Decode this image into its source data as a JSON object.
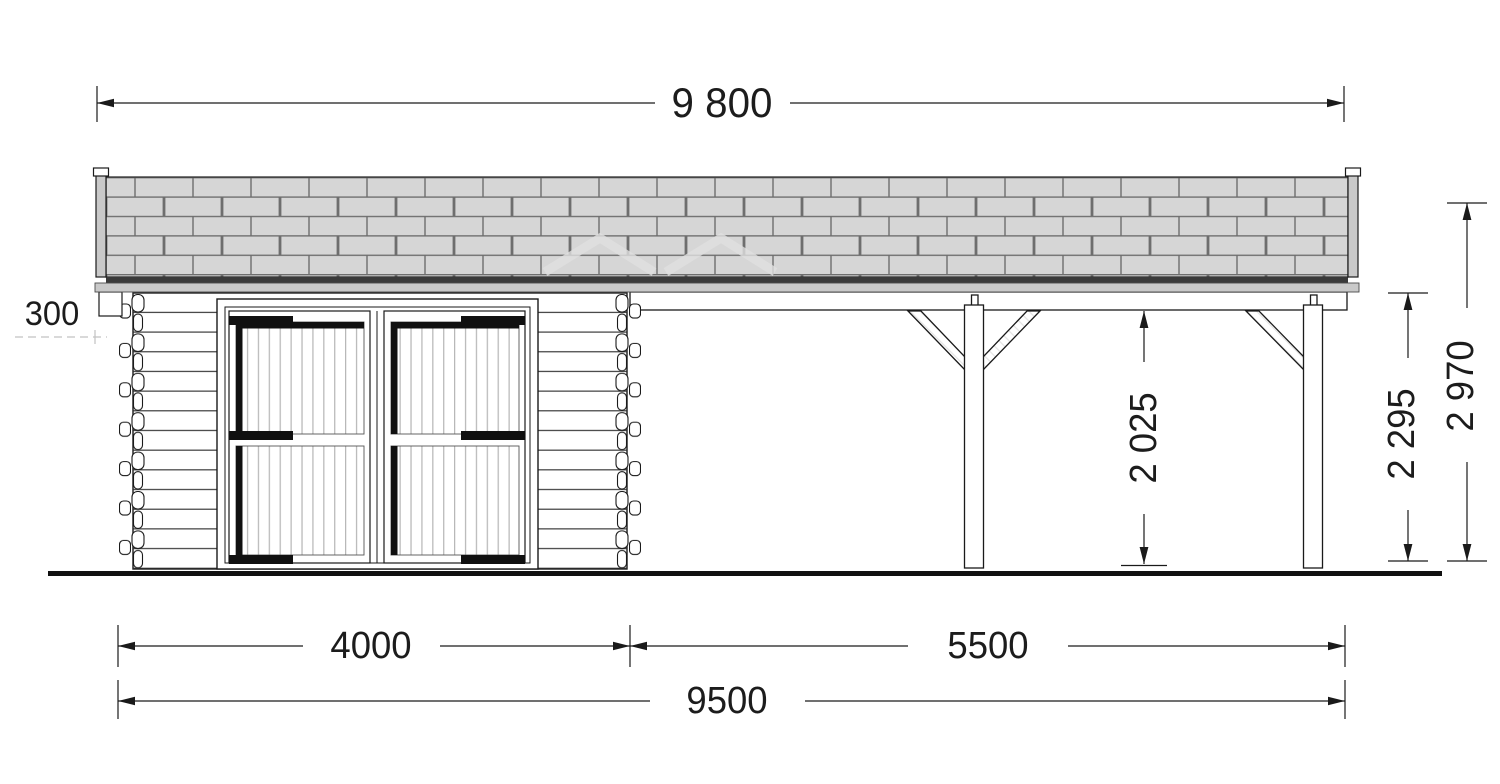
{
  "drawing": {
    "dimensions_mm": {
      "total_roof_width": "9 800",
      "eave_overhang": "300",
      "garage_section_width": "4000",
      "carport_section_width": "5500",
      "base_total_width": "9500",
      "carport_clear_height": "2 025",
      "wall_height": "2 295",
      "overall_height": "2 970"
    },
    "colors": {
      "line": "#1a1a1a",
      "roof_shingle_fill": "#d6d6d6",
      "roof_shingle_joint": "#6e6e6e",
      "roof_edge_band": "#3a3a3a",
      "fascia_fill": "#c9c9c9",
      "door_hardware": "#101010",
      "door_plank_line": "#b8b8b8",
      "background": "#ffffff"
    }
  }
}
